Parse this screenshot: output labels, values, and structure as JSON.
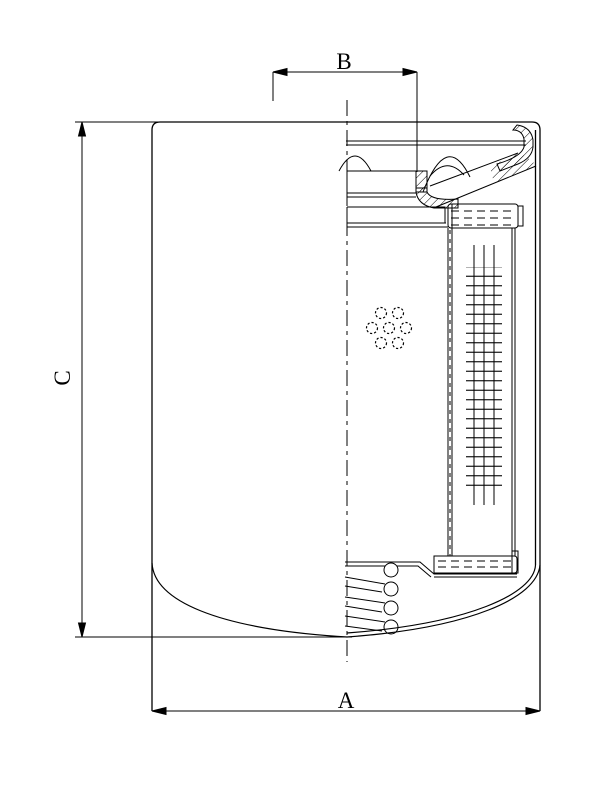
{
  "drawing": {
    "subject": "spin-on filter cartridge half-section technical drawing",
    "background_color": "#ffffff",
    "line_color": "#000000"
  },
  "dimensions": {
    "A": {
      "label": "A",
      "axis": "horizontal",
      "position": "bottom"
    },
    "B": {
      "label": "B",
      "axis": "horizontal",
      "position": "top"
    },
    "C": {
      "label": "C",
      "axis": "vertical",
      "position": "left"
    }
  }
}
